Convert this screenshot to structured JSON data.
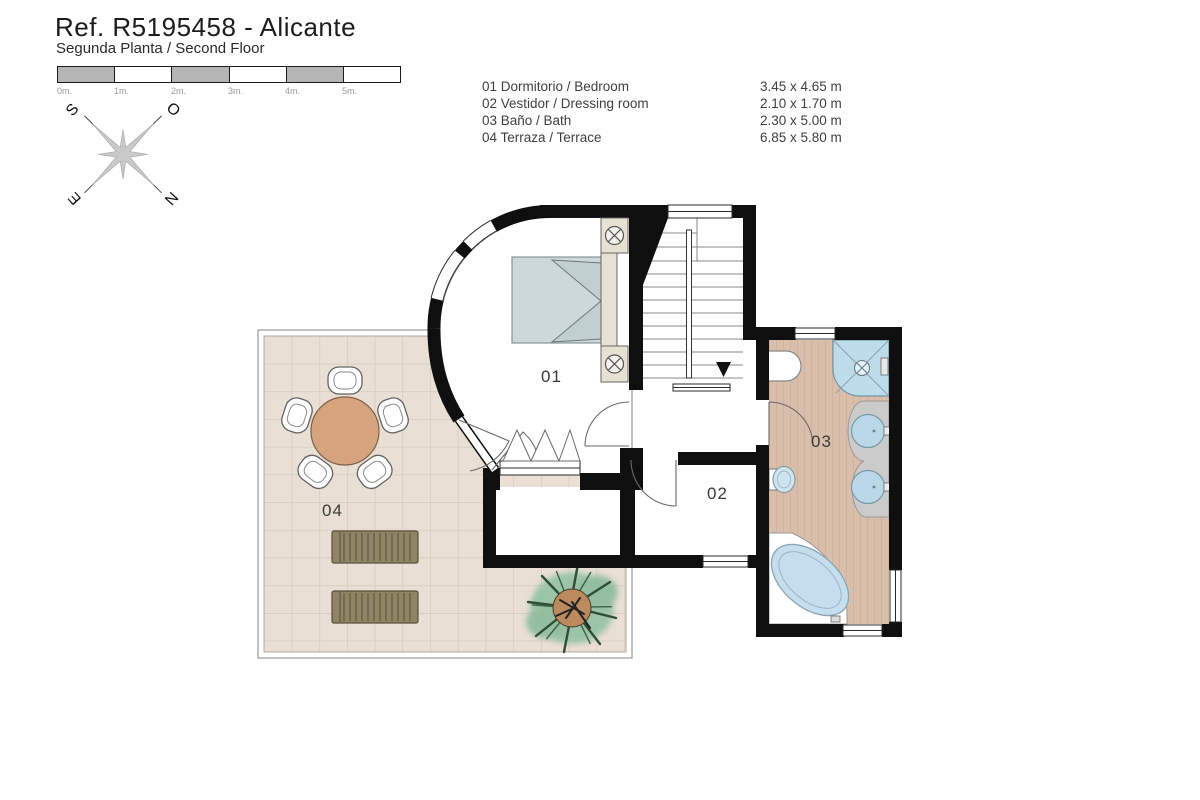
{
  "header": {
    "title": "Ref. R5195458 - Alicante",
    "subtitle": "Segunda Planta / Second Floor"
  },
  "scale_bar": {
    "labels": [
      "0m.",
      "1m.",
      "2m.",
      "3m.",
      "4m.",
      "5m."
    ]
  },
  "compass": {
    "letters": {
      "south": "S",
      "west": "O",
      "east": "E",
      "north": "N"
    }
  },
  "legend": {
    "rows": [
      {
        "label": "01 Dormitorio / Bedroom",
        "dimensions": "3.45 x 4.65 m"
      },
      {
        "label": "02 Vestidor / Dressing room",
        "dimensions": "2.10 x 1.70 m"
      },
      {
        "label": "03 Baño / Bath",
        "dimensions": "2.30 x 5.00 m"
      },
      {
        "label": "04 Terraza / Terrace",
        "dimensions": "6.85 x 5.80 m"
      }
    ]
  },
  "plan": {
    "rooms": [
      {
        "number": "01",
        "name": "Dormitorio / Bedroom"
      },
      {
        "number": "02",
        "name": "Vestidor / Dressing room"
      },
      {
        "number": "03",
        "name": "Baño / Bath"
      },
      {
        "number": "04",
        "name": "Terraza / Terrace"
      }
    ]
  },
  "colors": {
    "wall": "#0f0f0f",
    "terrace_floor": "#eadfd5",
    "terrace_grid": "#d2c5b7",
    "bathroom_floor": "#d9bfab",
    "water_blue": "#bedcec",
    "bed": "#ccd8da",
    "furniture_beige": "#e7e1d4",
    "table_wood": "#d5a47e",
    "lounger": "#8f8565",
    "plant_green": "#8fc1a0",
    "scale_gray": "#b5b5b5"
  }
}
